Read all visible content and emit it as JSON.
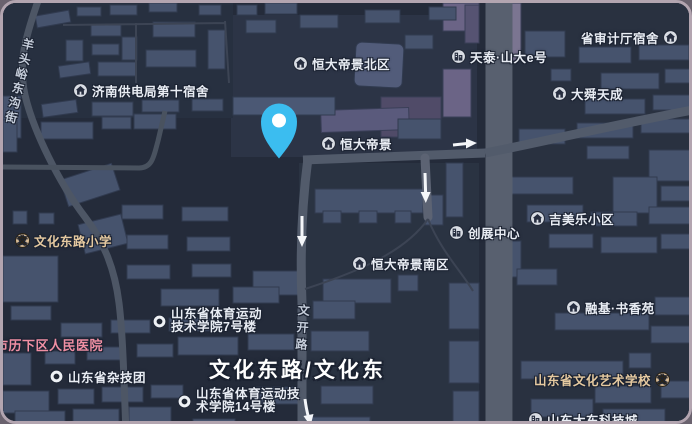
{
  "map": {
    "theme": "dark",
    "colors": {
      "ground": "#242b3a",
      "building": "#46536d",
      "road_major": "#58606f",
      "road_minor": "#525b6b",
      "frame_border": "#b3a5b0",
      "pin_blue": "#3bbdf0",
      "poi_text": "#e9edf4",
      "school_text": "#e5c9a0",
      "hospital_text": "#ef8fa3"
    },
    "pin": {
      "name": "selected-location-pin",
      "color": "#3bbdf0"
    }
  },
  "pois": [
    {
      "label": "济南供电局第十宿舍",
      "icon": "house"
    },
    {
      "label": "恒大帝景北区",
      "icon": "house"
    },
    {
      "label": "恒大帝景",
      "icon": "house"
    },
    {
      "label": "天泰·山大e号",
      "icon": "building"
    },
    {
      "label": "省审计厅宿舍",
      "icon": "house"
    },
    {
      "label": "大舜天成",
      "icon": "house"
    },
    {
      "label": "吉美乐小区",
      "icon": "house"
    },
    {
      "label": "创展中心",
      "icon": "building"
    },
    {
      "label": "恒大帝景南区",
      "icon": "house"
    },
    {
      "label": "融基·书香苑",
      "icon": "house"
    },
    {
      "label": "山东省文化艺术学校",
      "icon": "school"
    },
    {
      "label": "山东大东科技城",
      "icon": "building"
    },
    {
      "label": "文化东路小学",
      "icon": "school"
    },
    {
      "label": "市历下区人民医院",
      "icon": "none"
    },
    {
      "label": "山东省杂技团",
      "icon": "dot"
    },
    {
      "line1": "山东省体育运动",
      "line2": "技术学院7号楼",
      "icon": "dot"
    },
    {
      "line1": "山东省体育运动技",
      "line2": "术学院14号楼",
      "icon": "dot"
    }
  ],
  "road_labels": {
    "main": "文化东路/文化东",
    "left_street": "羊头峪东沟街",
    "wenkai": "文开路"
  }
}
